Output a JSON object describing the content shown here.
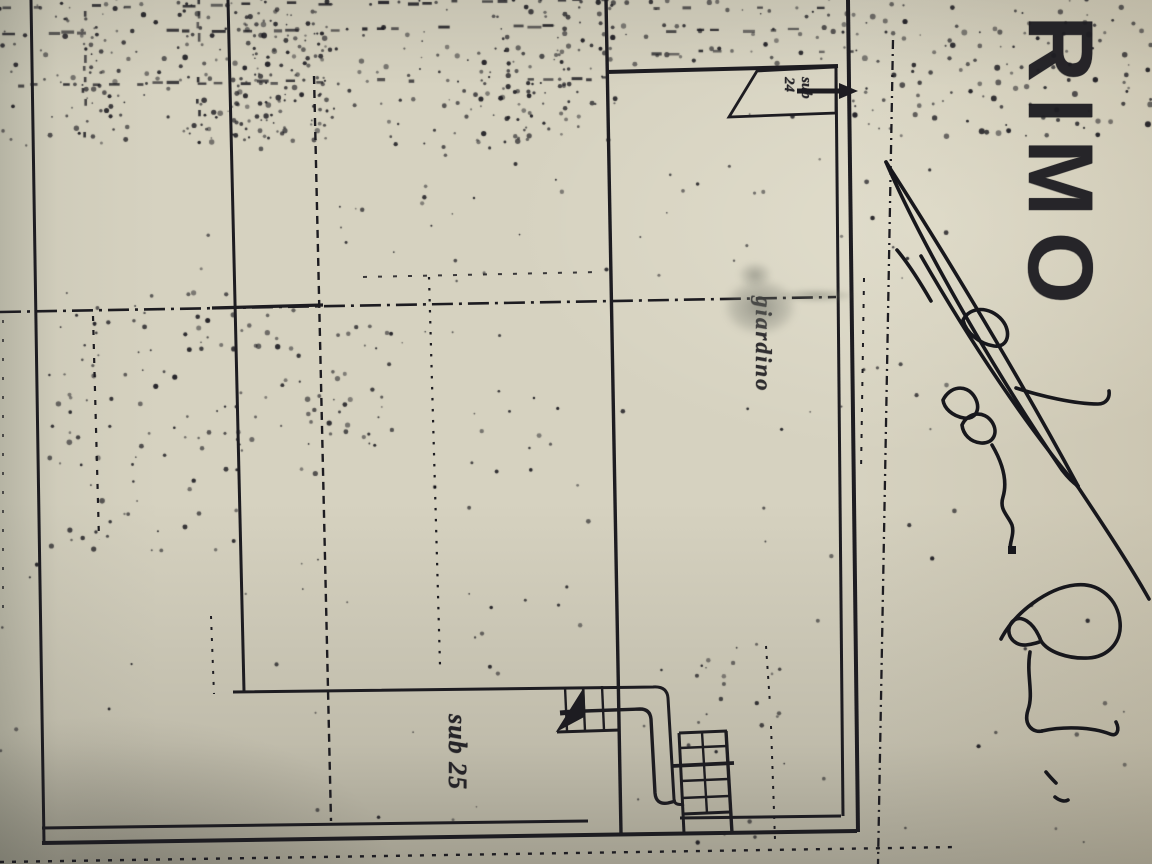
{
  "photo": {
    "floor_title": "PRIMO",
    "plan_labels": {
      "garden": "giardino",
      "unit_lower": "sub 25",
      "flag_line1": "sub",
      "flag_line2": "24"
    },
    "signature_note": "illegible handwritten signature",
    "colors": {
      "ink": "#1d1c21",
      "paper": "#d6d2c0"
    }
  }
}
